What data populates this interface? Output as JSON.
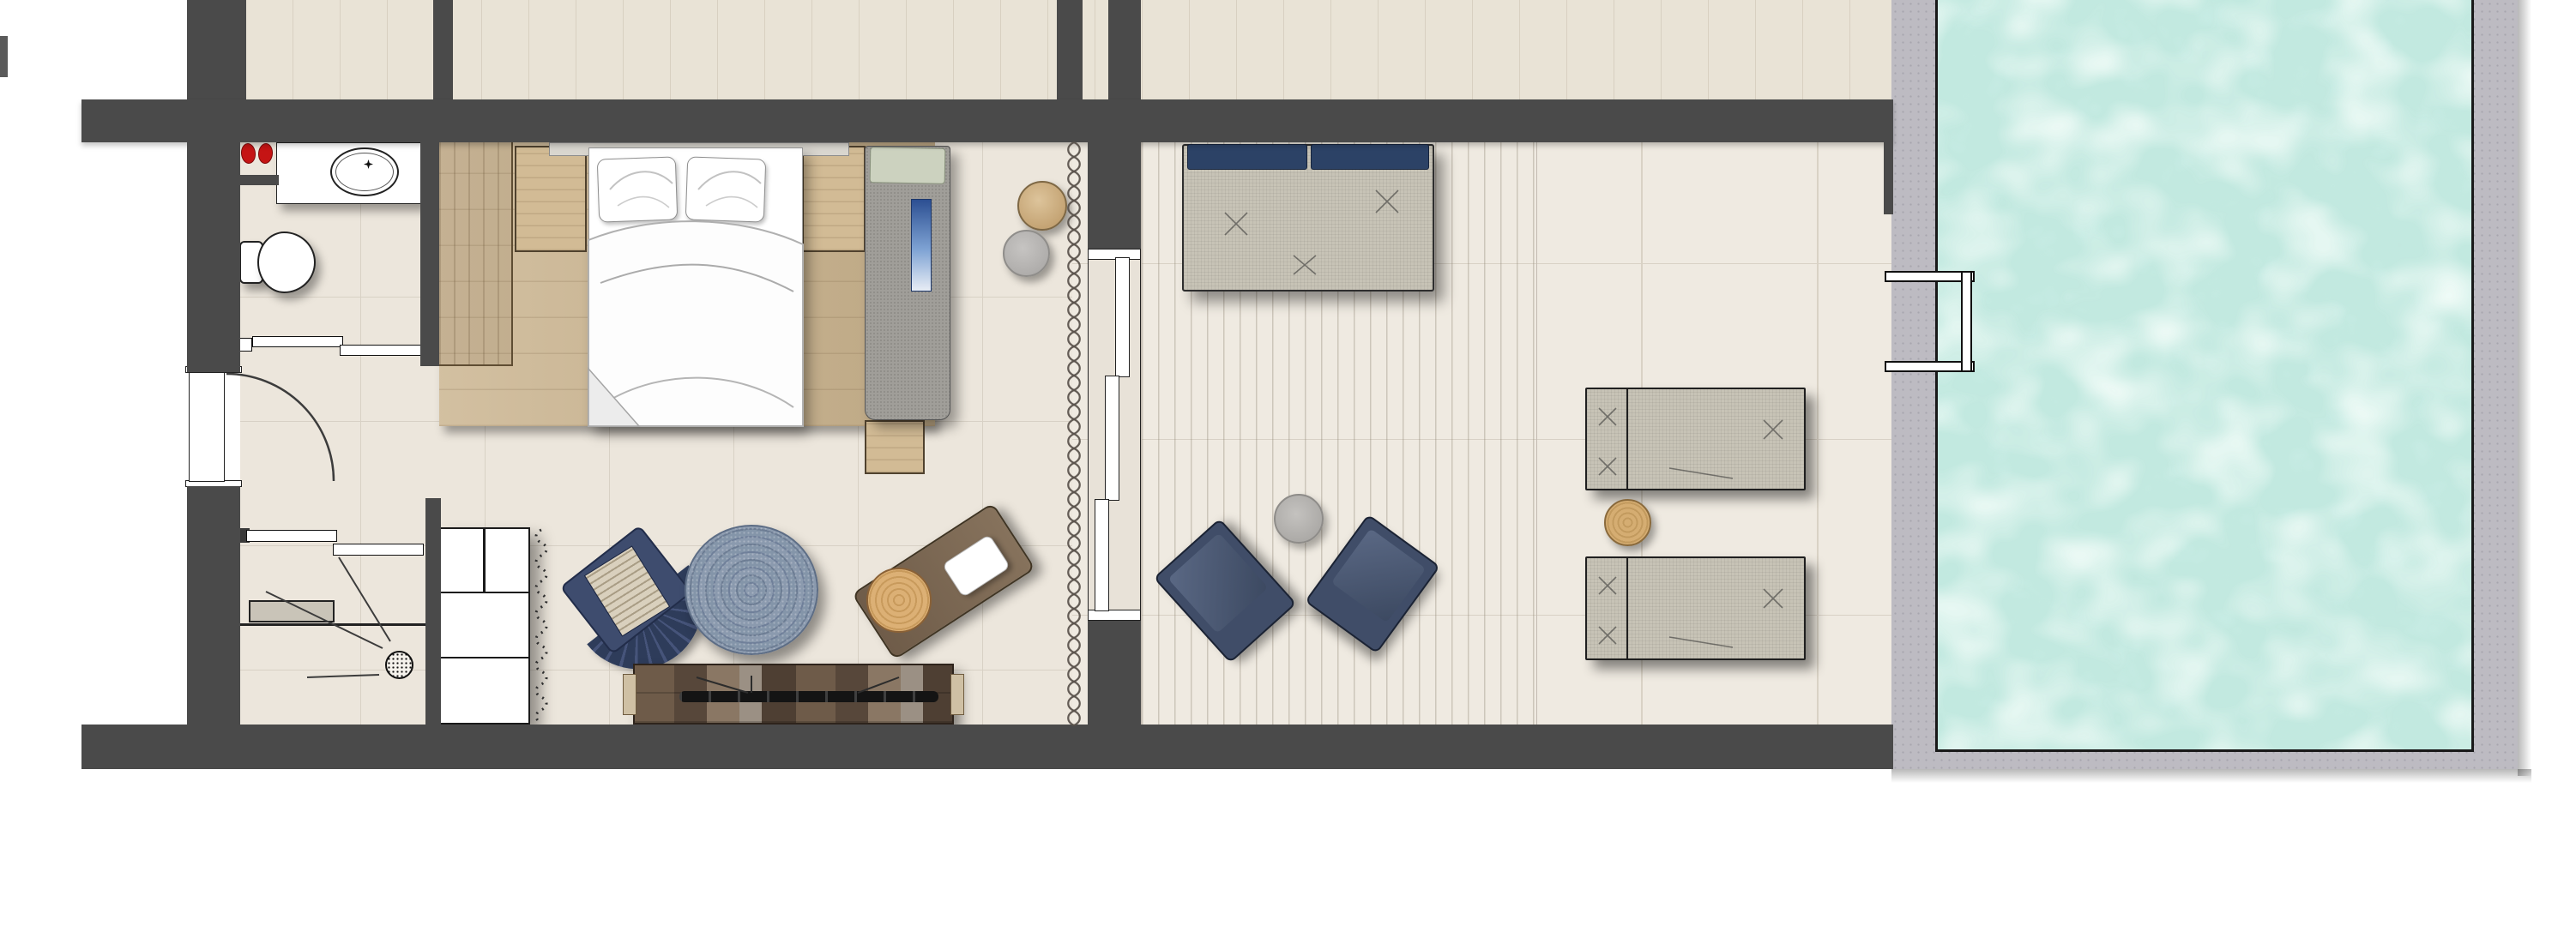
{
  "scene": {
    "type": "architectural-floor-plan",
    "view": "top-down",
    "subject": "hotel suite: bathroom, shower, bedroom, living area, decked terrace and private pool"
  },
  "palette": {
    "wall": "#4a4a4a",
    "floor": "#ece6dc",
    "grout": "#d8d1c5",
    "upper_floor": "#e9e3d6",
    "plank_line": "#d8d0c1",
    "terrace": "#efeae1",
    "wood": "#c9b28c",
    "greige": "#c7c3b6",
    "greige_dark": "#a09e99",
    "navy": "#31405f",
    "rug_blue": "#7f90a4",
    "console_wood": "#6e5b49",
    "pool_deck": "#bdbbc2",
    "water": "#c2e9e0",
    "water_light": "#ecfbf5",
    "hatch_a": "#a7d2e0",
    "hatch_b": "#6fa8bb",
    "red": "#c51414",
    "curtain": "#58504a"
  },
  "inventory": {
    "bathroom": [
      "vanity-counter",
      "oval-sink",
      "faucet",
      "red-slippers",
      "toilet",
      "pocket-sliding-door"
    ],
    "shower": [
      "glass-block-window",
      "bench",
      "floor-drain",
      "spray-lines",
      "pocket-sliding-door"
    ],
    "entry": [
      "entrance-door",
      "swing-arc"
    ],
    "bedroom": [
      "wood-platform",
      "wardrobe",
      "nightstand",
      "double-bed",
      "two-pillows",
      "duvet",
      "gray-daybed",
      "blue-runner",
      "tan-pouf",
      "gray-pouf",
      "curtain-symbol",
      "three-panel-sliding-glass-door"
    ],
    "living": [
      "white-shelf-unit",
      "dotted-garland",
      "navy-fan-armchair",
      "round-jute-rug",
      "wood-chaise",
      "rustic-console",
      "soundbar"
    ],
    "terrace": [
      "outdoor-sofa-with-blue-pillows",
      "two-navy-lounge-chairs",
      "gray-side-table",
      "two-sun-loungers",
      "wood-side-table",
      "deck-boards"
    ],
    "pool": [
      "water",
      "concrete-deck",
      "grab-rail-ladder"
    ]
  },
  "counts": {
    "sun_loungers": 2,
    "lounge_chairs": 2,
    "bed_pillows": 2,
    "blue_sofa_pillows": 2,
    "poufs": 2
  }
}
